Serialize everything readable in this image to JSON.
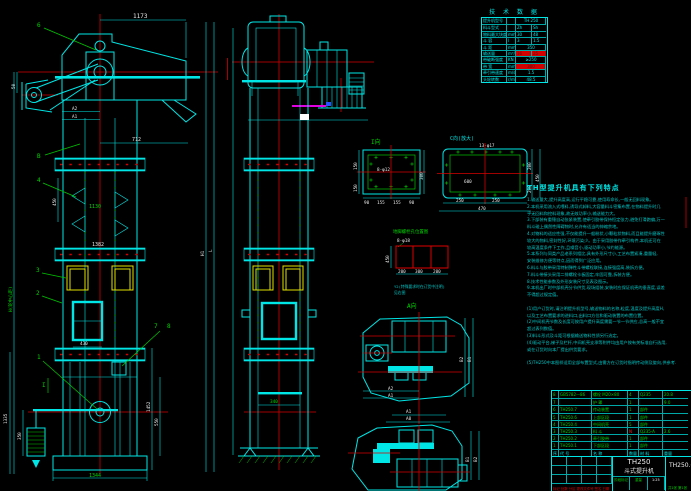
{
  "colors": {
    "cad_cyan": "#00e6e6",
    "cad_green": "#00c800",
    "cad_red": "#d40000",
    "cad_yellow": "#e0e000",
    "cad_magenta": "#e000e0",
    "cad_white": "#e8e8e8",
    "background": "#000000"
  },
  "tech_table": {
    "title": "技 术 数 据",
    "rows": [
      {
        "label": "提升机型号",
        "unit": "",
        "v1": "TH 250",
        "v2": "",
        "span": true,
        "red": false
      },
      {
        "label": "料斗型式",
        "unit": "",
        "v1": "Zh",
        "v2": "Sh",
        "span": false,
        "red": false
      },
      {
        "label": "物料最大块度",
        "unit": "mm",
        "v1": "30",
        "v2": "48",
        "span": false,
        "red": false
      },
      {
        "label": "斗  容",
        "unit": "l",
        "v1": "3",
        "v2": "1.5",
        "span": false,
        "red": false
      },
      {
        "label": "斗  距",
        "unit": "mm",
        "v1": "350",
        "v2": "",
        "span": true,
        "red": false
      },
      {
        "label": "输送量",
        "unit": "m³/h",
        "v1": "16",
        "v2": "25",
        "span": false,
        "red": true
      },
      {
        "label": "带破断强度",
        "unit": "KN",
        "v1": "≥250",
        "v2": "",
        "span": true,
        "red": false
      },
      {
        "label": "带  宽",
        "unit": "mm",
        "v1": "300",
        "v2": "",
        "span": true,
        "red": true
      },
      {
        "label": "牵引带速度",
        "unit": "m/s",
        "v1": "1.5",
        "v2": "",
        "span": true,
        "red": false
      },
      {
        "label": "头轮转数",
        "unit": "r/min",
        "v1": "48.5",
        "v2": "",
        "span": true,
        "red": false
      }
    ]
  },
  "notes": {
    "title": "TH型提升机具有下列特点",
    "lines": [
      "1.输送量大,提升高度高,运行平稳可靠,使用寿命长,一般无回料现象。",
      "2.本机采用流入式喂料,诱导式卸料,大容量料斗密集布置,在物料提升时几",
      "  乎无回料和挖料现象,故无效功率小,输送能力大。",
      "3.下部装有重锤自动张紧装置,使牵引胶带保持恒定张力,避免打滑跑偏,万一",
      "  料斗碰上偶然性障碍物时,允许有适当的伸缩余地。",
      "4.对物料的适应性强,不仅能提升一般粉状,小颗粒状物料,而且能提升磨琢性",
      "  较大的物料,密封性好,环境污染少。由于采用胶带作牵引构件,本机还可在",
      "  较高温度条件下工作,且噪音小,驱动功率小,节约能源。",
      "5.本系列与同类产品老系列相比,具有外形尺寸小,工艺布置紧凑,重量轻,",
      "  安装维修方便等特点,因而得到广泛应用。",
      "6.料斗与胶带采用特制弹性斗带螺栓联接,连接强度高,装拆方便。",
      "7.料斗带接头采用二排螺栓卡板固定,牢固可靠,拆装方便。",
      "8.技术性能参数及外形安装尺寸见表及图示。",
      "9.本机出厂时中部机壳分节供货,现场组装,安装时应保证机壳的垂直度,误差",
      "  不得超过规定值。"
    ],
    "order_lines": [
      "(1)用户订货时,请注明提升机型号,输送物料的名称,粒度,温度及提升高度H,",
      "  以及工艺布置要求的进料口,出料口方位和驱动装置的布置位置。",
      "(2)中间机壳节数及长度可按用户提升高度需要一节一节供应,总高一般不宜",
      "  超过表列数值。",
      "(3)料斗形式及斗距可根据输送物料性质另行选定。",
      "(4)驱动平台,梯子及栏杆,中间机壳支承等附件均由用户按有关标准自行选用,",
      "  或在订货时向本厂提出供货要求。",
      "",
      "(5)TH250中本图样适用全部布置型式,由需方在订货时指明传动侧及旋向,供参考."
    ]
  },
  "bom": {
    "headers": [
      "序",
      "代  号",
      "名  称",
      "数量",
      "材 料",
      "重量"
    ],
    "rows": [
      [
        "8",
        "GB5782—86",
        "螺栓 M20×80",
        "4",
        "Q235",
        "20.8"
      ],
      [
        "7",
        "",
        "护 罩",
        "1",
        "",
        "9.0"
      ],
      [
        "6",
        "TH250.7",
        "传动装置",
        "1",
        "部件",
        ""
      ],
      [
        "5",
        "TH250.6",
        "上部区段",
        "1",
        "部件",
        ""
      ],
      [
        "4",
        "TH250.4",
        "中间机壳",
        "5",
        "部件",
        ""
      ],
      [
        "3",
        "TH250.3",
        "料 斗",
        "N",
        "Q235-A",
        "2.6"
      ],
      [
        "2",
        "TH250.2",
        "牵引胶带",
        "1",
        "部件",
        ""
      ],
      [
        "1",
        "TH250.1",
        "下部区段",
        "1",
        "部件",
        ""
      ]
    ]
  },
  "title_block": {
    "model": "TH250",
    "name": "斗式提升机",
    "dwg_no": "TH250.0",
    "rev_row": "标记 处数 分区 更改文件号 签名 日期",
    "stage_label": "阶段标记",
    "weight_label": "重量",
    "scale_label": "比例",
    "scale": "1:25",
    "sheet": "共1张 第1张"
  },
  "fv": {
    "d1173": "1173",
    "l6": "6",
    "d50": "50",
    "a2": "A2",
    "a1": "A1",
    "d712": "712",
    "lb": "B",
    "l4": "4",
    "d450": "450",
    "d1130": "1130",
    "d1382": "1382",
    "l3": "3",
    "l2": "2",
    "d430": "430",
    "l7": "7",
    "l8": "8",
    "l1": "1",
    "si": "I",
    "d1335": "1335",
    "d350": "350",
    "d1452": "1452",
    "d550": "550",
    "d1344": "1344",
    "axis_h": "H(轮中心距)",
    "axis_l": "L",
    "axis_h1": "H1"
  },
  "sv": {
    "d340": "340"
  },
  "di": {
    "title": "I向",
    "hole": "8-φ12",
    "s150a": "150",
    "s150b": "150",
    "s300": "300",
    "b1": "90",
    "b2": "155",
    "b3": "155",
    "b4": "90"
  },
  "dc": {
    "title": "C向(放大)",
    "hole": "13-φ17",
    "inner": "600",
    "r200a": "200",
    "r200b": "200",
    "r450": "450",
    "b250a": "250",
    "b250b": "250",
    "total470": "470"
  },
  "da": {
    "title": "地脚螺栓孔位置图",
    "hole": "8-φ18",
    "left450": "450",
    "b200a": "200",
    "b300": "300",
    "b200b": "200",
    "note1": "Y2(特殊要求时在订货中注明)",
    "note2": "见右图"
  },
  "pv": {
    "title": "A向",
    "b1": "B1",
    "b2": "B2",
    "a2": "A2",
    "a1": "A1",
    "a1b": "A1",
    "a0": "A0",
    "b1b": "B1",
    "b2b": "B2"
  }
}
